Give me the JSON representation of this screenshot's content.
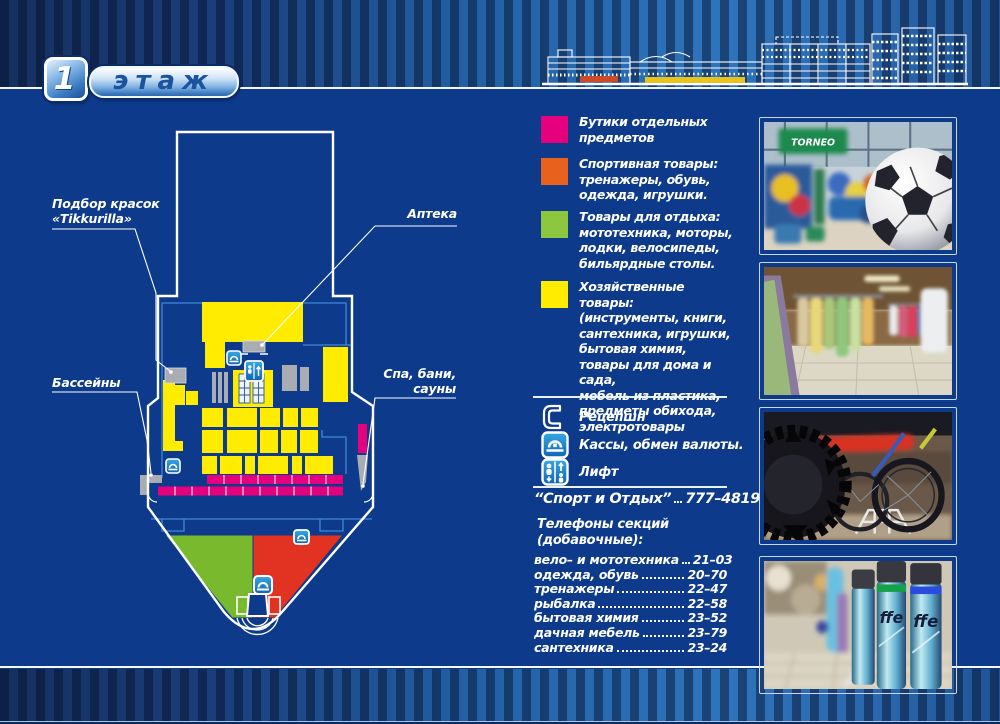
{
  "header": {
    "floor_number": "1",
    "floor_label": "этаж"
  },
  "map_labels": {
    "paint": "Подбор красок\n«Tikkurilla»",
    "pharmacy": "Аптека",
    "pools": "Бассейны",
    "spa": "Спа, бани,\nсауны"
  },
  "legend": {
    "items": [
      {
        "name": "boutiques",
        "color": "#e5007d",
        "text": "Бутики отдельных\nпредметов"
      },
      {
        "name": "sports",
        "color": "#e8611d",
        "text": "Спортивная товары:\nтренажеры, обувь,\nодежда, игрушки."
      },
      {
        "name": "leisure",
        "color": "#8dc63f",
        "text": "Товары для отдыха:\nмототехника, моторы,\nлодки, велосипеды,\nбильярдные столы."
      },
      {
        "name": "household",
        "color": "#ffec00",
        "text": "Хозяйственные товары:\n(инструменты, книги,\nсантехника, игрушки,\nбытовая химия,\nтовары для дома и сада,\nмебель из пластика,\nпредметы обихода,\nэлектротовары"
      }
    ],
    "facilities": [
      {
        "icon": "phone-icon",
        "label": "Рецепшн"
      },
      {
        "icon": "cash-icon",
        "label": "Кассы, обмен валюты."
      },
      {
        "icon": "elevator-icon",
        "label": "Лифт"
      }
    ]
  },
  "phones": {
    "main": {
      "name": "“Спорт и Отдых”",
      "number": "777–4819"
    },
    "heading": "Телефоны секций\n(добавочные):",
    "sections": [
      {
        "name": "вело– и мототехника",
        "number": "21–03"
      },
      {
        "name": "одежда, обувь",
        "number": "20–70"
      },
      {
        "name": "тренажеры",
        "number": "22–47"
      },
      {
        "name": "рыбалка",
        "number": "22–58"
      },
      {
        "name": "бытовая химия",
        "number": "23–52"
      },
      {
        "name": "дачная мебель",
        "number": "23–79"
      },
      {
        "name": "сантехника",
        "number": "23–24"
      }
    ]
  },
  "photos": [
    {
      "name": "sports-goods-photo",
      "sign": "TORNEO"
    },
    {
      "name": "clothing-store-photo"
    },
    {
      "name": "bicycles-photo"
    },
    {
      "name": "spray-cans-photo",
      "brand": "ffe"
    }
  ],
  "colors": {
    "background": "#0d3a8a",
    "zone_pink": "#e5007d",
    "zone_orange": "#e8611d",
    "zone_green": "#8dc63f",
    "zone_yellow": "#ffec00",
    "zone_red": "#e23222"
  }
}
